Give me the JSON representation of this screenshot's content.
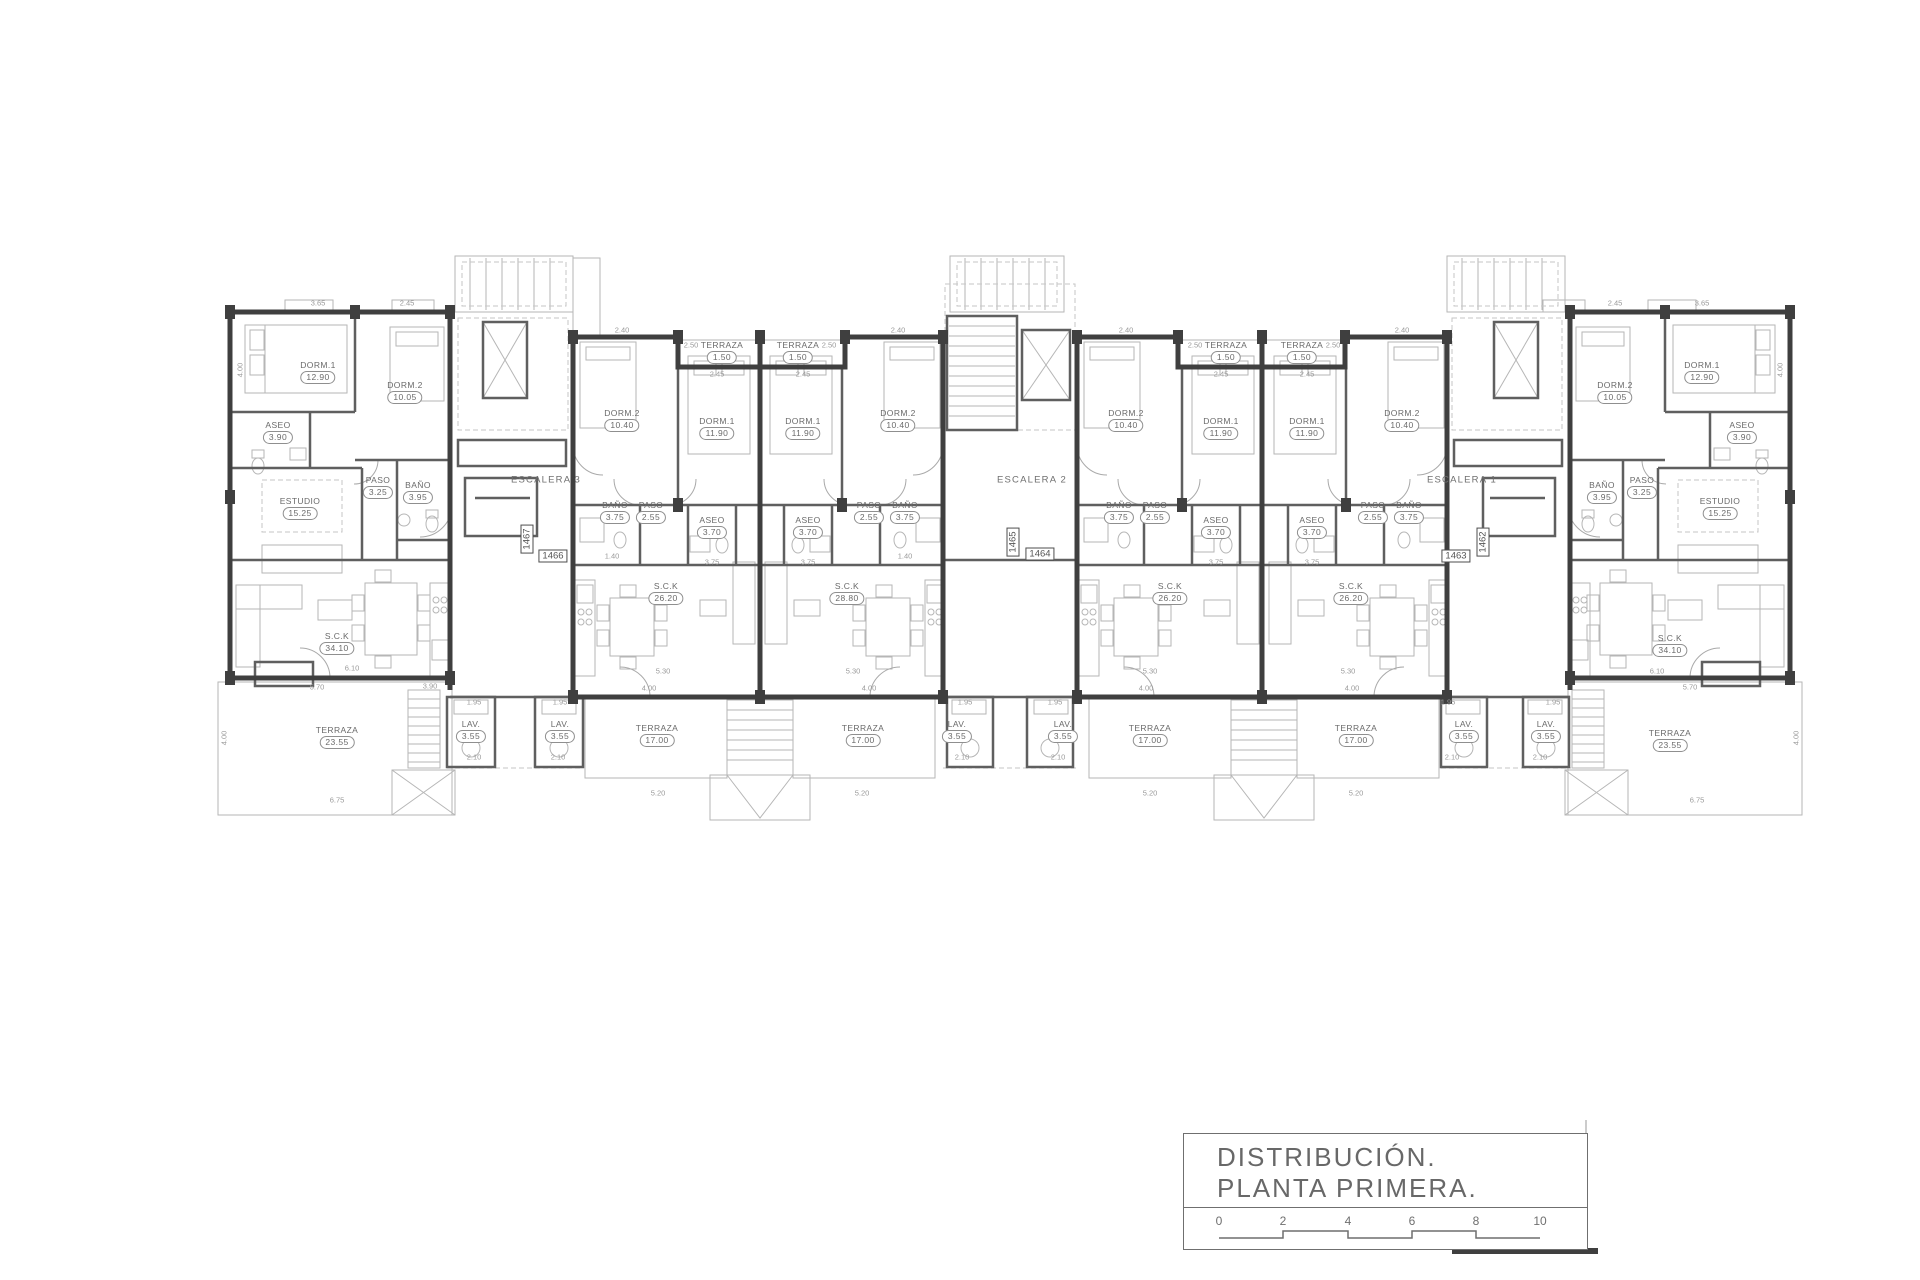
{
  "title_block": {
    "line1": "DISTRIBUCIÓN.",
    "line2": "PLANTA  PRIMERA.",
    "scale_ticks": [
      "0",
      "2",
      "4",
      "6",
      "8",
      "10"
    ]
  },
  "plan": {
    "stair_labels": [
      {
        "t": "ESCALERA 3",
        "x": 546,
        "y": 480
      },
      {
        "t": "ESCALERA 2",
        "x": 1032,
        "y": 480
      },
      {
        "t": "ESCALERA 1",
        "x": 1462,
        "y": 480
      }
    ],
    "unit_tags": [
      {
        "t": "1467",
        "x": 527,
        "y": 539,
        "v": true
      },
      {
        "t": "1466",
        "x": 553,
        "y": 556
      },
      {
        "t": "1465",
        "x": 1013,
        "y": 542,
        "v": true
      },
      {
        "t": "1464",
        "x": 1040,
        "y": 554
      },
      {
        "t": "1462",
        "x": 1483,
        "y": 542,
        "v": true
      },
      {
        "t": "1463",
        "x": 1456,
        "y": 556
      }
    ],
    "rooms": [
      {
        "n": "DORM.1",
        "a": "12.90",
        "x": 318,
        "y": 372
      },
      {
        "n": "DORM.2",
        "a": "10.05",
        "x": 405,
        "y": 392
      },
      {
        "n": "ASEO",
        "a": "3.90",
        "x": 278,
        "y": 432
      },
      {
        "n": "PASO",
        "a": "3.25",
        "x": 378,
        "y": 487
      },
      {
        "n": "BAÑO",
        "a": "3.95",
        "x": 418,
        "y": 492
      },
      {
        "n": "ESTUDIO",
        "a": "15.25",
        "x": 300,
        "y": 508
      },
      {
        "n": "S.C.K",
        "a": "34.10",
        "x": 337,
        "y": 643
      },
      {
        "n": "TERRAZA",
        "a": "23.55",
        "x": 337,
        "y": 737
      },
      {
        "n": "LAV.",
        "a": "3.55",
        "x": 471,
        "y": 731
      },
      {
        "n": "LAV.",
        "a": "3.55",
        "x": 560,
        "y": 731
      },
      {
        "n": "DORM.2",
        "a": "10.40",
        "x": 622,
        "y": 420
      },
      {
        "n": "DORM.1",
        "a": "11.90",
        "x": 717,
        "y": 428
      },
      {
        "n": "TERRAZA",
        "a": "1.50",
        "x": 722,
        "y": 352
      },
      {
        "n": "TERRAZA",
        "a": "1.50",
        "x": 798,
        "y": 352
      },
      {
        "n": "DORM.1",
        "a": "11.90",
        "x": 803,
        "y": 428
      },
      {
        "n": "DORM.2",
        "a": "10.40",
        "x": 898,
        "y": 420
      },
      {
        "n": "BAÑO",
        "a": "3.75",
        "x": 615,
        "y": 512
      },
      {
        "n": "PASO",
        "a": "2.55",
        "x": 651,
        "y": 512
      },
      {
        "n": "ASEO",
        "a": "3.70",
        "x": 712,
        "y": 527
      },
      {
        "n": "ASEO",
        "a": "3.70",
        "x": 808,
        "y": 527
      },
      {
        "n": "PASO",
        "a": "2.55",
        "x": 869,
        "y": 512
      },
      {
        "n": "BAÑO",
        "a": "3.75",
        "x": 905,
        "y": 512
      },
      {
        "n": "S.C.K",
        "a": "26.20",
        "x": 666,
        "y": 593
      },
      {
        "n": "S.C.K",
        "a": "28.80",
        "x": 847,
        "y": 593
      },
      {
        "n": "TERRAZA",
        "a": "17.00",
        "x": 657,
        "y": 735
      },
      {
        "n": "TERRAZA",
        "a": "17.00",
        "x": 863,
        "y": 735
      },
      {
        "n": "LAV.",
        "a": "3.55",
        "x": 957,
        "y": 731
      },
      {
        "n": "LAV.",
        "a": "3.55",
        "x": 1063,
        "y": 731
      },
      {
        "n": "DORM.2",
        "a": "10.40",
        "x": 1126,
        "y": 420
      },
      {
        "n": "DORM.1",
        "a": "11.90",
        "x": 1221,
        "y": 428
      },
      {
        "n": "TERRAZA",
        "a": "1.50",
        "x": 1226,
        "y": 352
      },
      {
        "n": "TERRAZA",
        "a": "1.50",
        "x": 1302,
        "y": 352
      },
      {
        "n": "DORM.1",
        "a": "11.90",
        "x": 1307,
        "y": 428
      },
      {
        "n": "DORM.2",
        "a": "10.40",
        "x": 1402,
        "y": 420
      },
      {
        "n": "BAÑO",
        "a": "3.75",
        "x": 1119,
        "y": 512
      },
      {
        "n": "PASO",
        "a": "2.55",
        "x": 1155,
        "y": 512
      },
      {
        "n": "ASEO",
        "a": "3.70",
        "x": 1216,
        "y": 527
      },
      {
        "n": "ASEO",
        "a": "3.70",
        "x": 1312,
        "y": 527
      },
      {
        "n": "PASO",
        "a": "2.55",
        "x": 1373,
        "y": 512
      },
      {
        "n": "BAÑO",
        "a": "3.75",
        "x": 1409,
        "y": 512
      },
      {
        "n": "S.C.K",
        "a": "26.20",
        "x": 1170,
        "y": 593
      },
      {
        "n": "S.C.K",
        "a": "26.20",
        "x": 1351,
        "y": 593
      },
      {
        "n": "TERRAZA",
        "a": "17.00",
        "x": 1150,
        "y": 735
      },
      {
        "n": "TERRAZA",
        "a": "17.00",
        "x": 1356,
        "y": 735
      },
      {
        "n": "LAV.",
        "a": "3.55",
        "x": 1464,
        "y": 731
      },
      {
        "n": "LAV.",
        "a": "3.55",
        "x": 1546,
        "y": 731
      },
      {
        "n": "DORM.2",
        "a": "10.05",
        "x": 1615,
        "y": 392
      },
      {
        "n": "DORM.1",
        "a": "12.90",
        "x": 1702,
        "y": 372
      },
      {
        "n": "ASEO",
        "a": "3.90",
        "x": 1742,
        "y": 432
      },
      {
        "n": "PASO",
        "a": "3.25",
        "x": 1642,
        "y": 487
      },
      {
        "n": "BAÑO",
        "a": "3.95",
        "x": 1602,
        "y": 492
      },
      {
        "n": "ESTUDIO",
        "a": "15.25",
        "x": 1720,
        "y": 508
      },
      {
        "n": "S.C.K",
        "a": "34.10",
        "x": 1670,
        "y": 645
      },
      {
        "n": "TERRAZA",
        "a": "23.55",
        "x": 1670,
        "y": 740
      }
    ],
    "dims": [
      {
        "t": "3.65",
        "x": 318,
        "y": 303
      },
      {
        "t": "2.45",
        "x": 407,
        "y": 303
      },
      {
        "t": "2.40",
        "x": 622,
        "y": 330
      },
      {
        "t": "2.50",
        "x": 691,
        "y": 345
      },
      {
        "t": "2.45",
        "x": 717,
        "y": 374
      },
      {
        "t": "2.45",
        "x": 803,
        "y": 374
      },
      {
        "t": "2.50",
        "x": 829,
        "y": 345
      },
      {
        "t": "2.40",
        "x": 898,
        "y": 330
      },
      {
        "t": "2.40",
        "x": 1126,
        "y": 330
      },
      {
        "t": "2.50",
        "x": 1195,
        "y": 345
      },
      {
        "t": "2.45",
        "x": 1221,
        "y": 374
      },
      {
        "t": "2.45",
        "x": 1307,
        "y": 374
      },
      {
        "t": "2.50",
        "x": 1333,
        "y": 345
      },
      {
        "t": "2.40",
        "x": 1402,
        "y": 330
      },
      {
        "t": "2.45",
        "x": 1615,
        "y": 303
      },
      {
        "t": "3.65",
        "x": 1702,
        "y": 303
      },
      {
        "t": "4.00",
        "x": 240,
        "y": 370,
        "r": 1
      },
      {
        "t": "4.00",
        "x": 1780,
        "y": 370,
        "r": 1
      },
      {
        "t": "4.00",
        "x": 224,
        "y": 738,
        "r": 1
      },
      {
        "t": "4.00",
        "x": 1796,
        "y": 738,
        "r": 1
      },
      {
        "t": "1.40",
        "x": 612,
        "y": 556
      },
      {
        "t": "1.40",
        "x": 905,
        "y": 556
      },
      {
        "t": "3.75",
        "x": 712,
        "y": 562
      },
      {
        "t": "3.75",
        "x": 808,
        "y": 562
      },
      {
        "t": "3.75",
        "x": 1216,
        "y": 562
      },
      {
        "t": "3.75",
        "x": 1312,
        "y": 562
      },
      {
        "t": "6.10",
        "x": 352,
        "y": 668
      },
      {
        "t": "5.70",
        "x": 317,
        "y": 687
      },
      {
        "t": "5.30",
        "x": 663,
        "y": 671
      },
      {
        "t": "4.00",
        "x": 649,
        "y": 688
      },
      {
        "t": "5.30",
        "x": 853,
        "y": 671
      },
      {
        "t": "4.00",
        "x": 869,
        "y": 688
      },
      {
        "t": "5.30",
        "x": 1150,
        "y": 671
      },
      {
        "t": "4.00",
        "x": 1146,
        "y": 688
      },
      {
        "t": "5.30",
        "x": 1348,
        "y": 671
      },
      {
        "t": "4.00",
        "x": 1352,
        "y": 688
      },
      {
        "t": "6.10",
        "x": 1657,
        "y": 671
      },
      {
        "t": "5.70",
        "x": 1690,
        "y": 687
      },
      {
        "t": "3.90",
        "x": 430,
        "y": 686
      },
      {
        "t": "1.95",
        "x": 474,
        "y": 702
      },
      {
        "t": "2.10",
        "x": 474,
        "y": 757
      },
      {
        "t": "1.95",
        "x": 560,
        "y": 702
      },
      {
        "t": "2.10",
        "x": 558,
        "y": 757
      },
      {
        "t": "1.95",
        "x": 965,
        "y": 702
      },
      {
        "t": "2.10",
        "x": 962,
        "y": 757
      },
      {
        "t": "1.95",
        "x": 1055,
        "y": 702
      },
      {
        "t": "2.10",
        "x": 1058,
        "y": 757
      },
      {
        "t": "1.95",
        "x": 1448,
        "y": 702
      },
      {
        "t": "2.10",
        "x": 1452,
        "y": 757
      },
      {
        "t": "1.95",
        "x": 1553,
        "y": 702
      },
      {
        "t": "2.10",
        "x": 1540,
        "y": 757
      },
      {
        "t": "6.75",
        "x": 337,
        "y": 800
      },
      {
        "t": "5.20",
        "x": 658,
        "y": 793
      },
      {
        "t": "5.20",
        "x": 862,
        "y": 793
      },
      {
        "t": "5.20",
        "x": 1150,
        "y": 793
      },
      {
        "t": "5.20",
        "x": 1356,
        "y": 793
      },
      {
        "t": "6.75",
        "x": 1697,
        "y": 800
      }
    ]
  }
}
